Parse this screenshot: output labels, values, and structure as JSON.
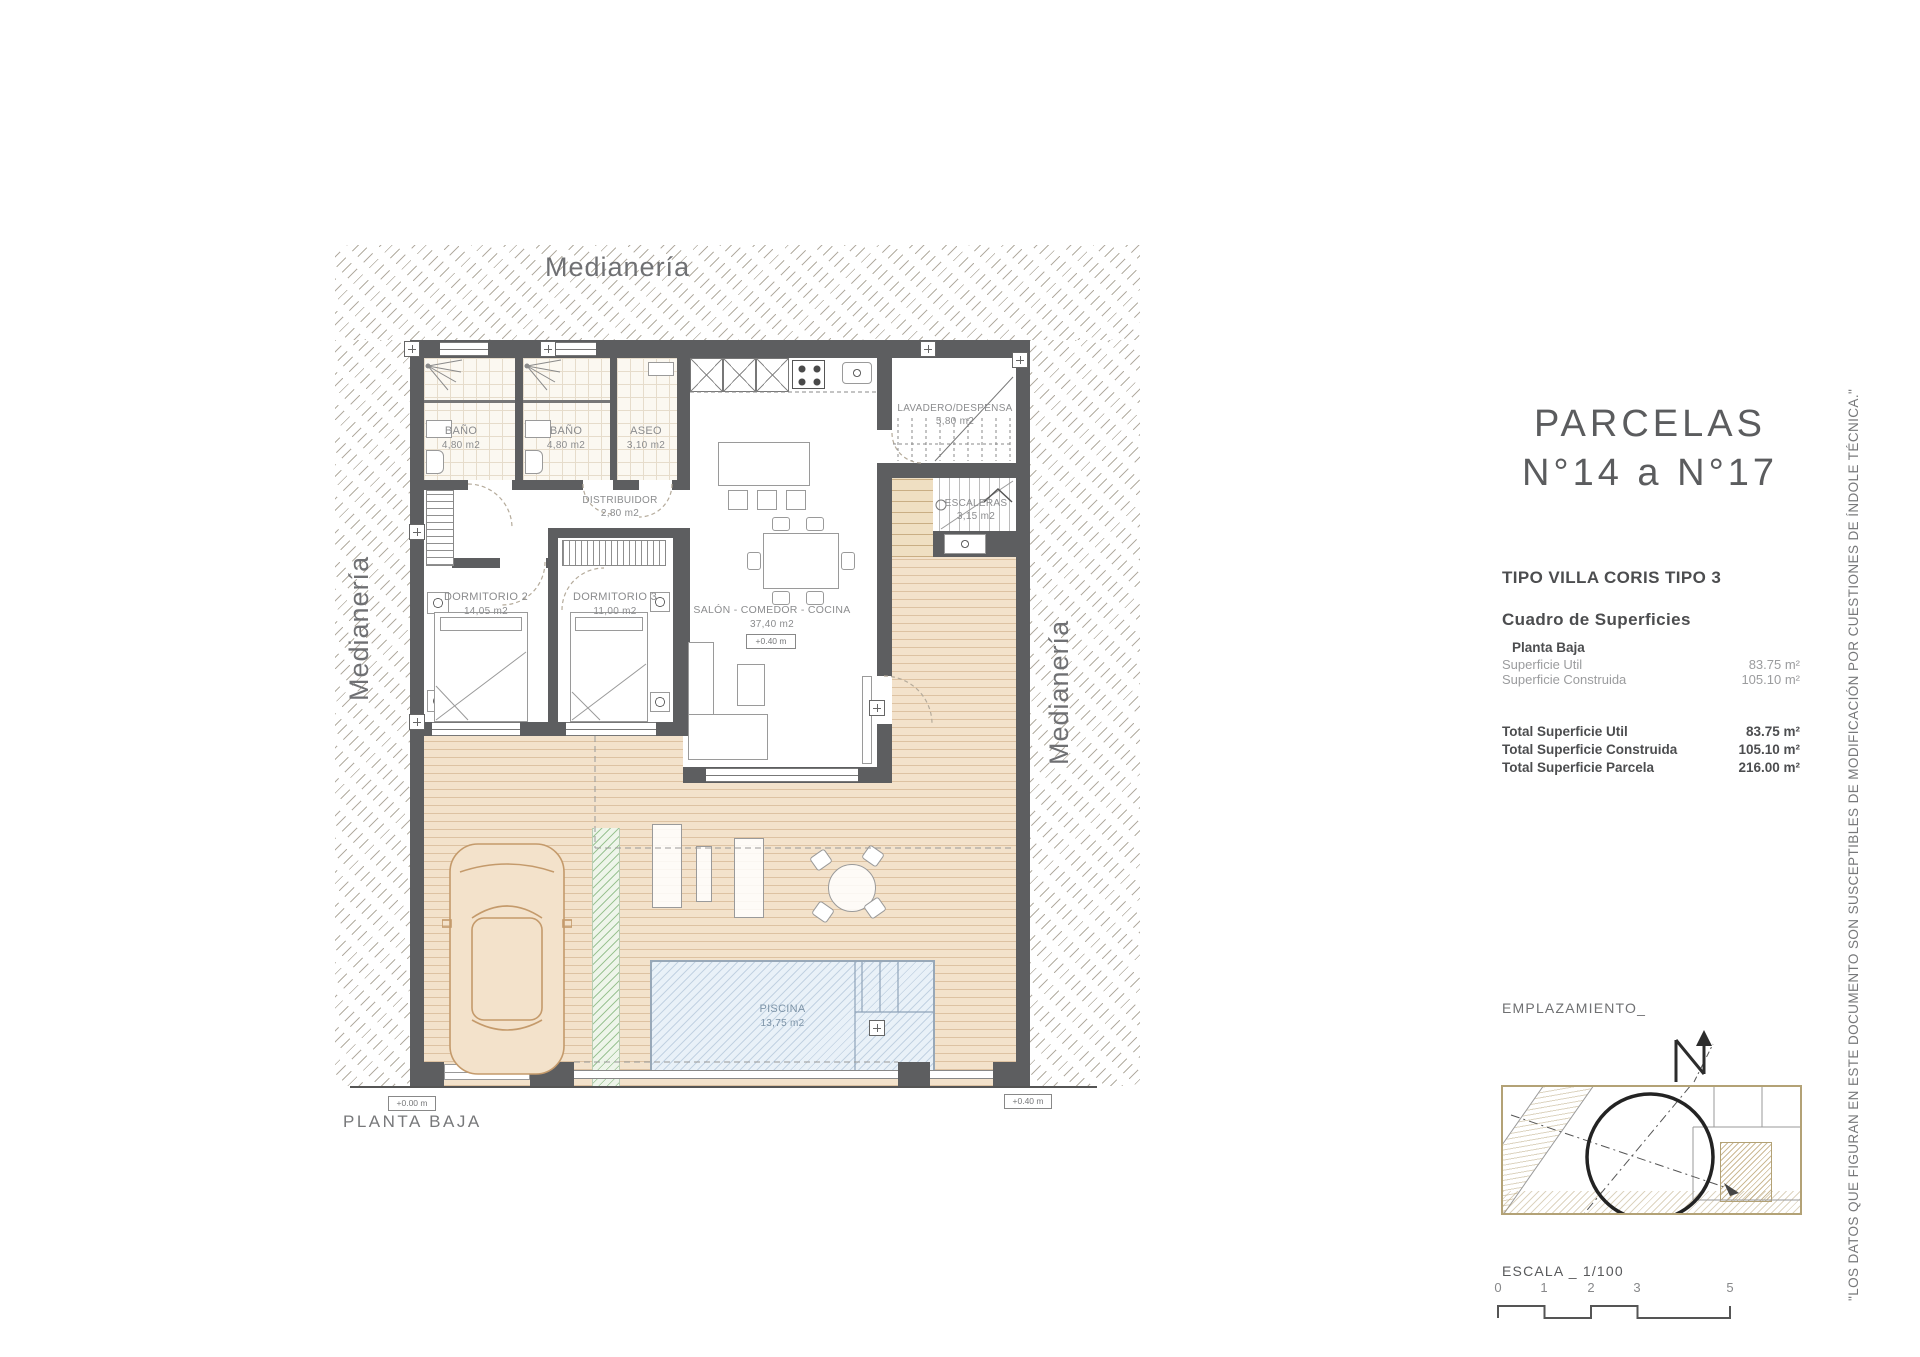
{
  "title": {
    "line1": "PARCELAS",
    "line2": "N°14 a N°17"
  },
  "plan": {
    "floor_name": "PLANTA BAJA",
    "medianeria": "Medianería",
    "rooms": [
      {
        "name": "BAÑO",
        "area": "4,80 m2"
      },
      {
        "name": "BAÑO",
        "area": "4,80 m2"
      },
      {
        "name": "ASEO",
        "area": "3,10 m2"
      },
      {
        "name": "LAVADERO/DESPENSA",
        "area": "5,80 m2"
      },
      {
        "name": "ESCALERAS",
        "area": "3,15 m2"
      },
      {
        "name": "DISTRIBUIDOR",
        "area": "2,80 m2"
      },
      {
        "name": "DORMITORIO 2",
        "area": "14,05 m2"
      },
      {
        "name": "DORMITORIO 3",
        "area": "11,00 m2"
      },
      {
        "name": "SALÓN - COMEDOR - COCINA",
        "area": "37,40 m2"
      },
      {
        "name": "PISCINA",
        "area": "13,75 m2"
      }
    ],
    "levels": {
      "salon": "+0.40 m",
      "entrance": "+0.00 m",
      "terrace": "+0.40 m"
    }
  },
  "panel": {
    "type_title": "TIPO VILLA CORIS TIPO 3",
    "table_title": "Cuadro de Superficies",
    "floor_label": "Planta Baja",
    "rows": [
      {
        "label": "Superficie Util",
        "value": "83.75 m²"
      },
      {
        "label": "Superficie Construida",
        "value": "105.10 m²"
      }
    ],
    "totals": [
      {
        "label": "Total Superficie Util",
        "value": "83.75 m²"
      },
      {
        "label": "Total Superficie Construida",
        "value": "105.10 m²"
      },
      {
        "label": "Total Superficie Parcela",
        "value": "216.00 m²"
      }
    ],
    "emplazamiento_label": "EMPLAZAMIENTO_",
    "escala_label": "ESCALA _ 1/100",
    "scale_ticks": [
      "0",
      "1",
      "2",
      "3",
      "5"
    ]
  },
  "disclaimer": "\"LOS DATOS QUE FIGURAN EN ESTE DOCUMENTO SON SUSCEPTIBLES DE MODIFICACIÓN POR CUESTIONES DE ÍNDOLE TÉCNICA.\""
}
